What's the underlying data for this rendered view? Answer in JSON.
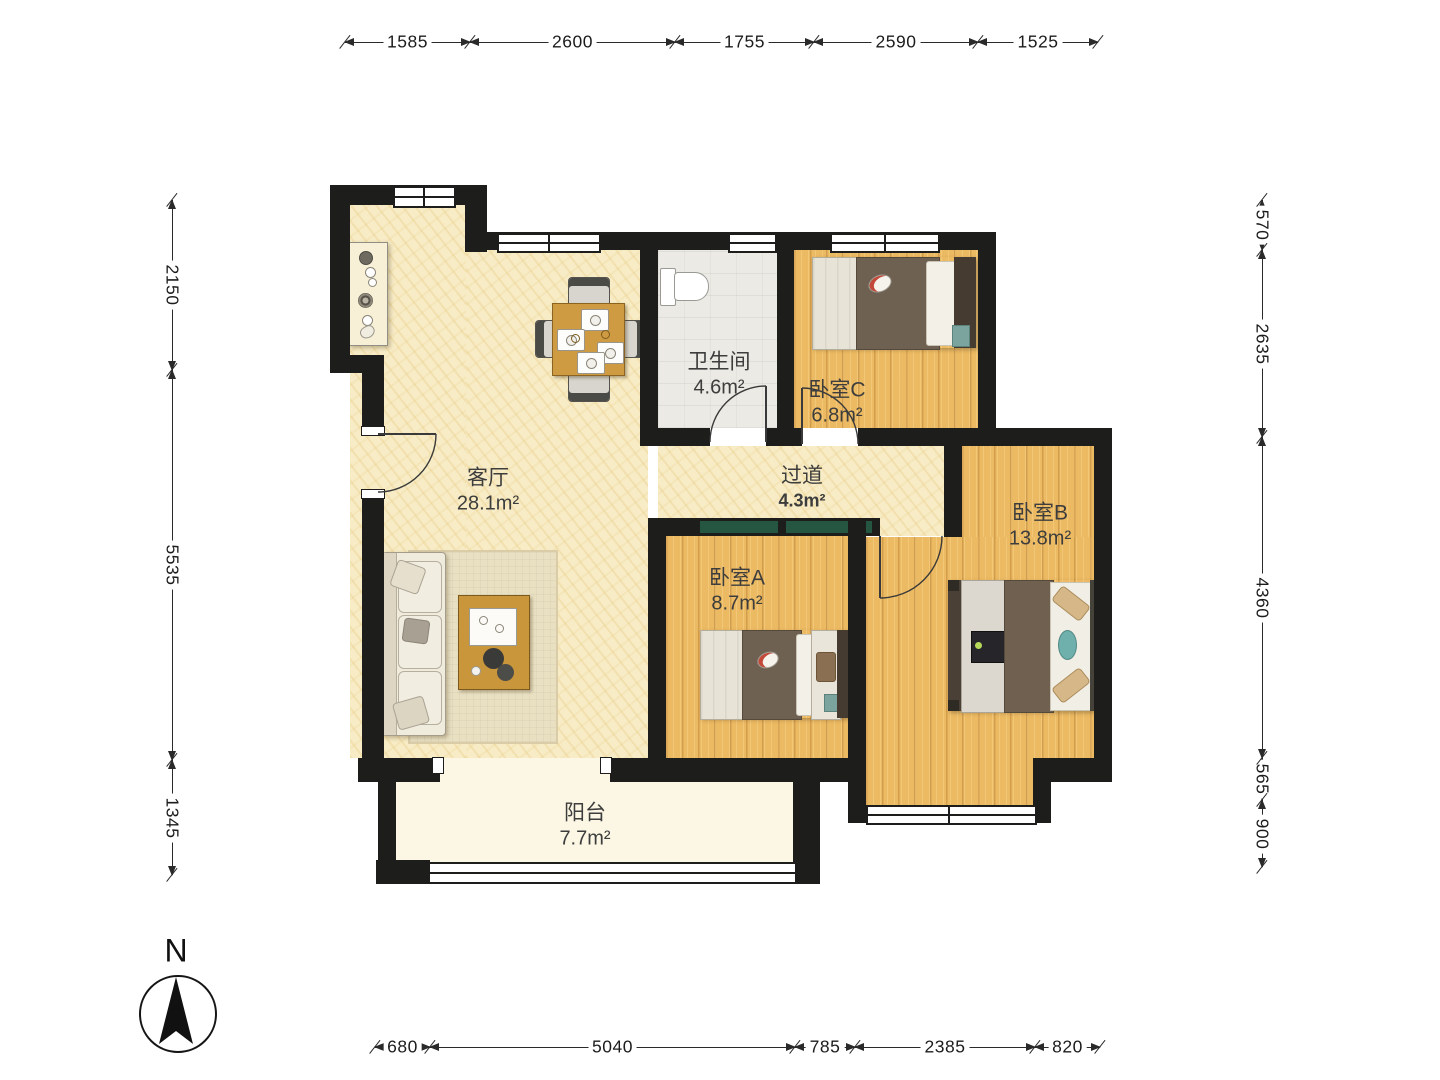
{
  "plan_type": "apartment-floor-plan",
  "compass": {
    "label": "N"
  },
  "rooms": [
    {
      "id": "living-room",
      "name": "客厅",
      "area": "28.1m²"
    },
    {
      "id": "bathroom",
      "name": "卫生间",
      "area": "4.6m²"
    },
    {
      "id": "bedroom-c",
      "name": "卧室C",
      "area": "6.8m²"
    },
    {
      "id": "hallway",
      "name": "过道",
      "area": "4.3m²"
    },
    {
      "id": "bedroom-a",
      "name": "卧室A",
      "area": "8.7m²"
    },
    {
      "id": "bedroom-b",
      "name": "卧室B",
      "area": "13.8m²"
    },
    {
      "id": "balcony",
      "name": "阳台",
      "area": "7.7m²"
    }
  ],
  "dimensions_mm": {
    "top": [
      "1585",
      "2600",
      "1755",
      "2590",
      "1525"
    ],
    "left": [
      "2150",
      "5535",
      "1345"
    ],
    "right": [
      "570",
      "2635",
      "4360",
      "565",
      "900"
    ],
    "bottom": [
      "680",
      "5040",
      "785",
      "2385",
      "820"
    ]
  },
  "colors": {
    "wall": "#1d1d1b",
    "floor_living": "#f7ecc5",
    "floor_wood": "#ecba62",
    "floor_bathroom": "#eceae4",
    "floor_balcony": "#fbf7e4",
    "sliding_door_accent": "#245641",
    "dimension_line": "#2a2a2a"
  }
}
